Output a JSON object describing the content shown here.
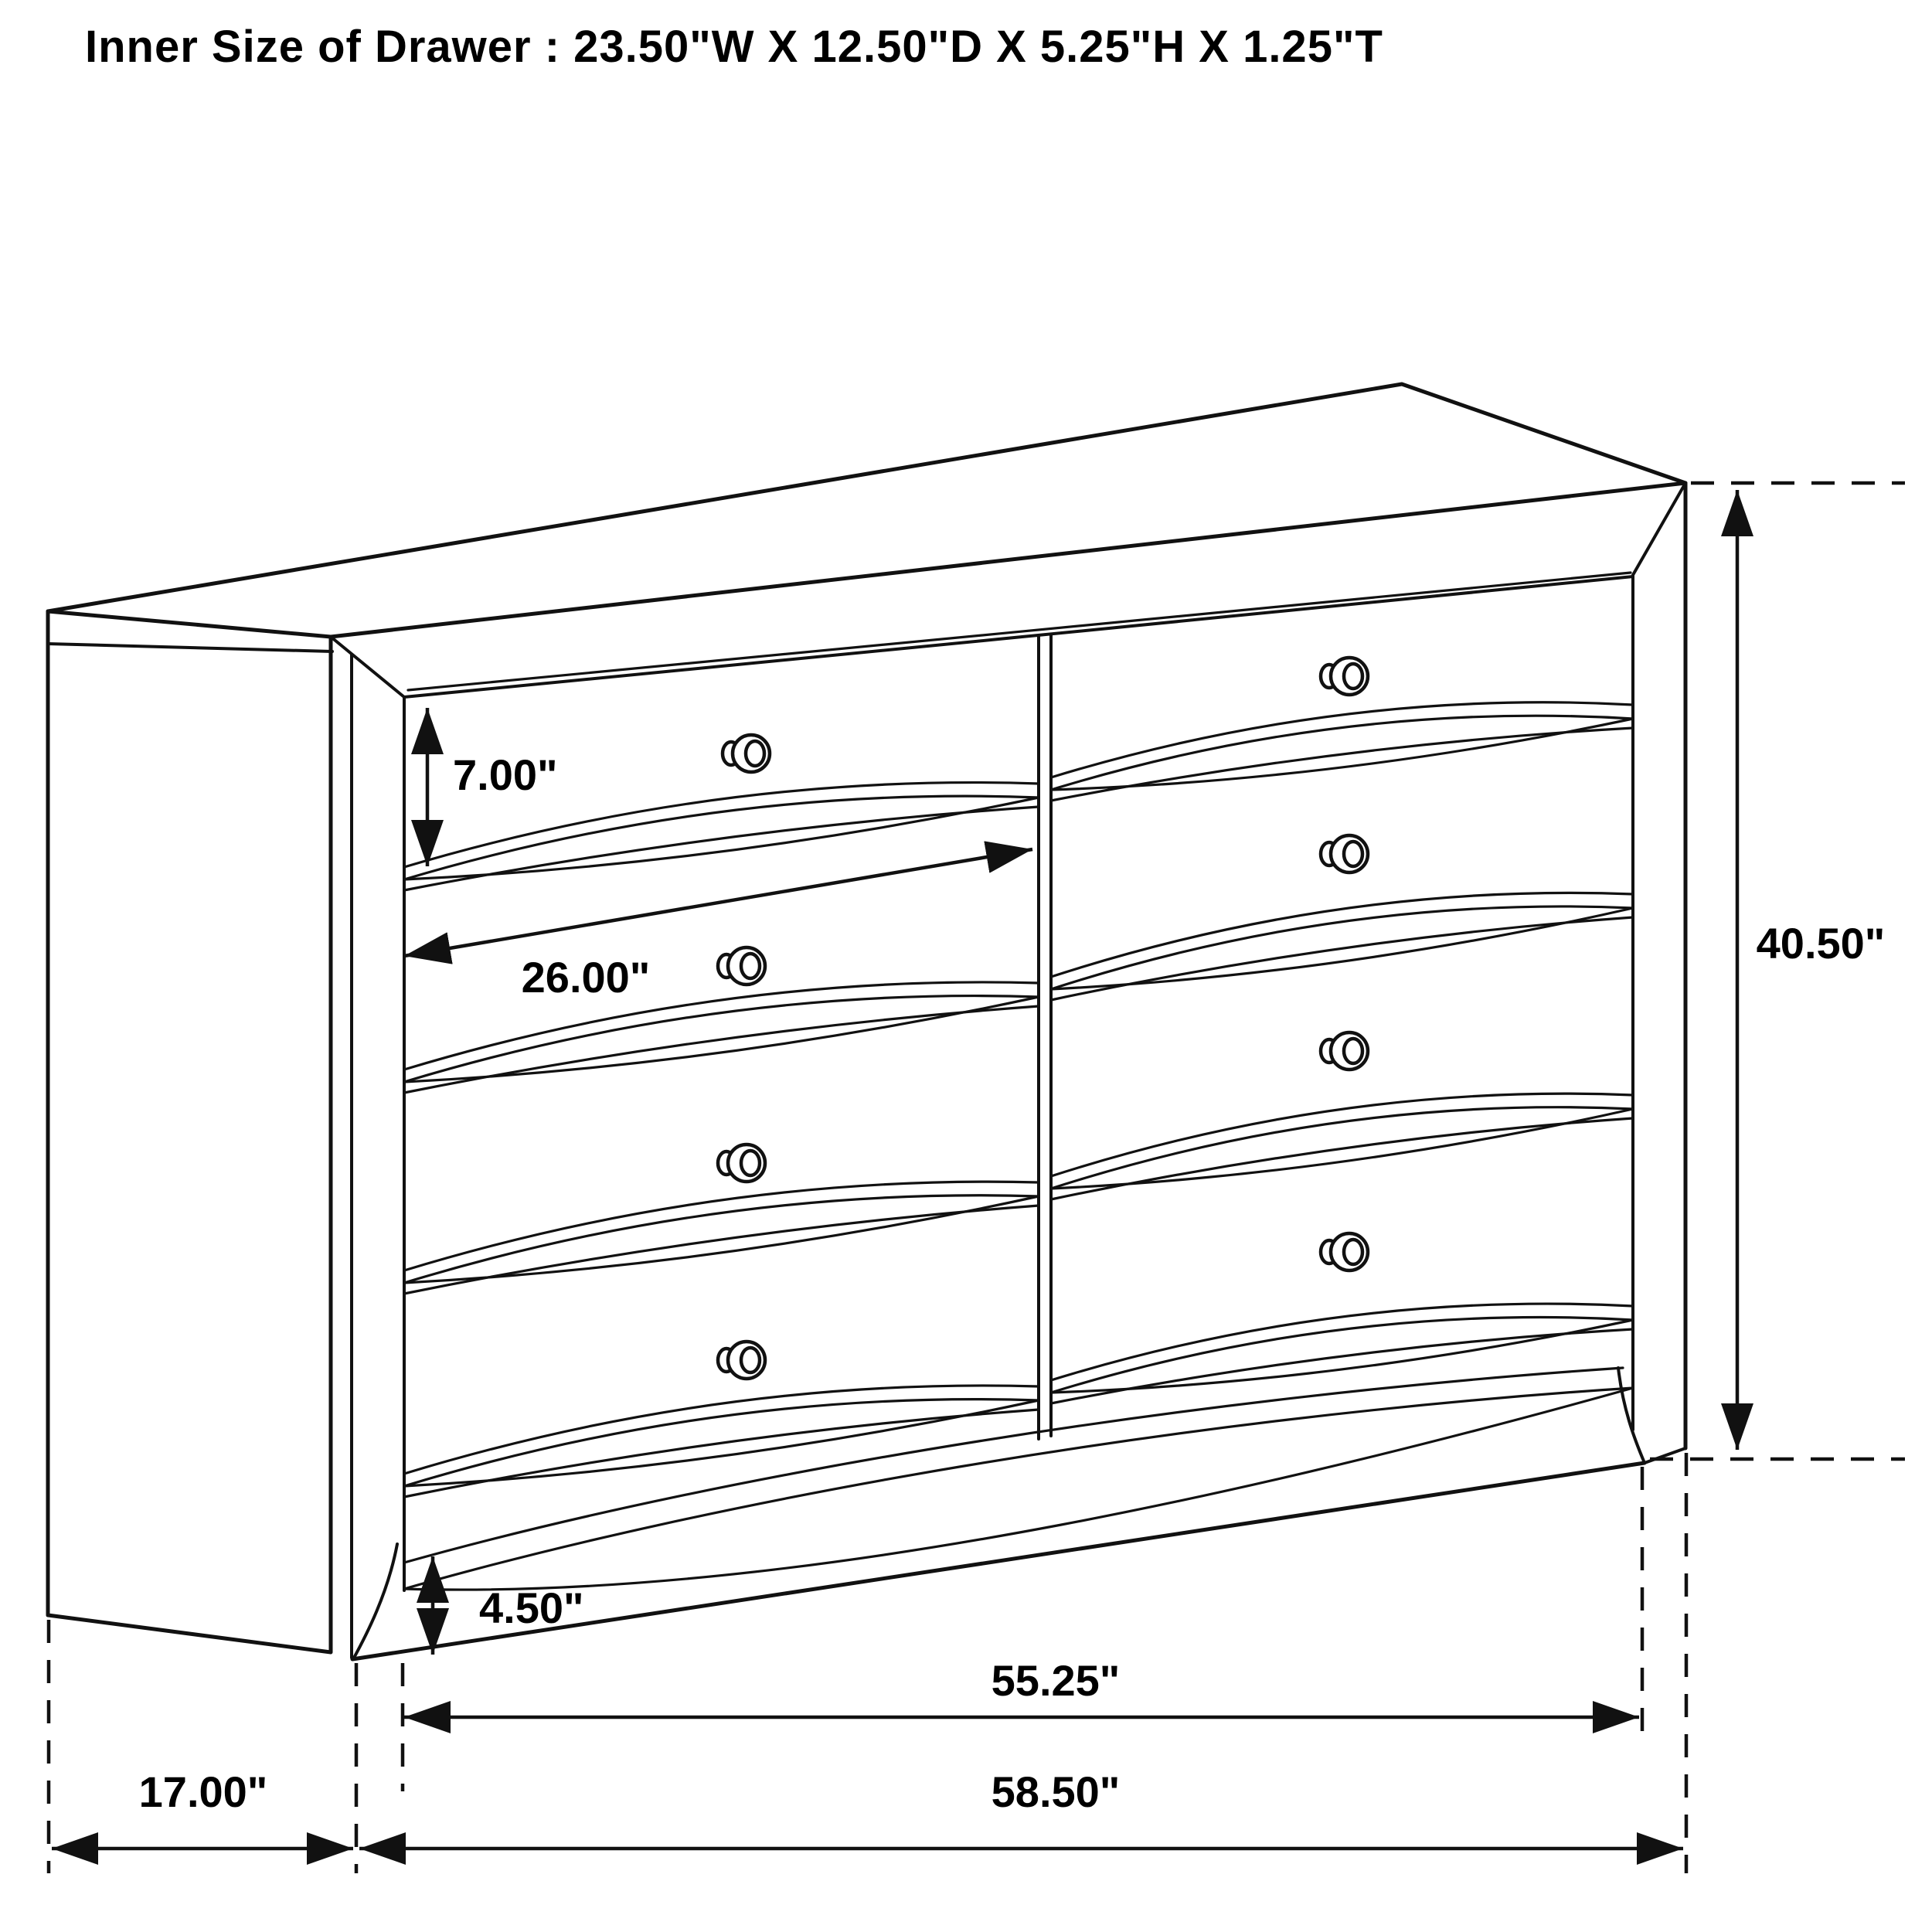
{
  "title": "Inner Size of Drawer : 23.50\"W X 12.50\"D X 5.25\"H X 1.25\"T",
  "inner_drawer_size": {
    "width": "23.50\"W",
    "depth": "12.50\"D",
    "height": "5.25\"H",
    "thickness": "1.25\"T"
  },
  "dimensions": {
    "drawer_opening_height": "7.00\"",
    "drawer_front_width": "26.00\"",
    "overall_height": "40.50\"",
    "foot_height": "4.50\"",
    "base_span": "55.25\"",
    "side_depth": "17.00\"",
    "overall_width": "58.50\""
  },
  "drawing": {
    "drawer_rows": 4,
    "drawer_columns": 2,
    "knob_count": 8
  },
  "colors": {
    "line": "#111111",
    "background": "#ffffff",
    "text": "#000000"
  }
}
